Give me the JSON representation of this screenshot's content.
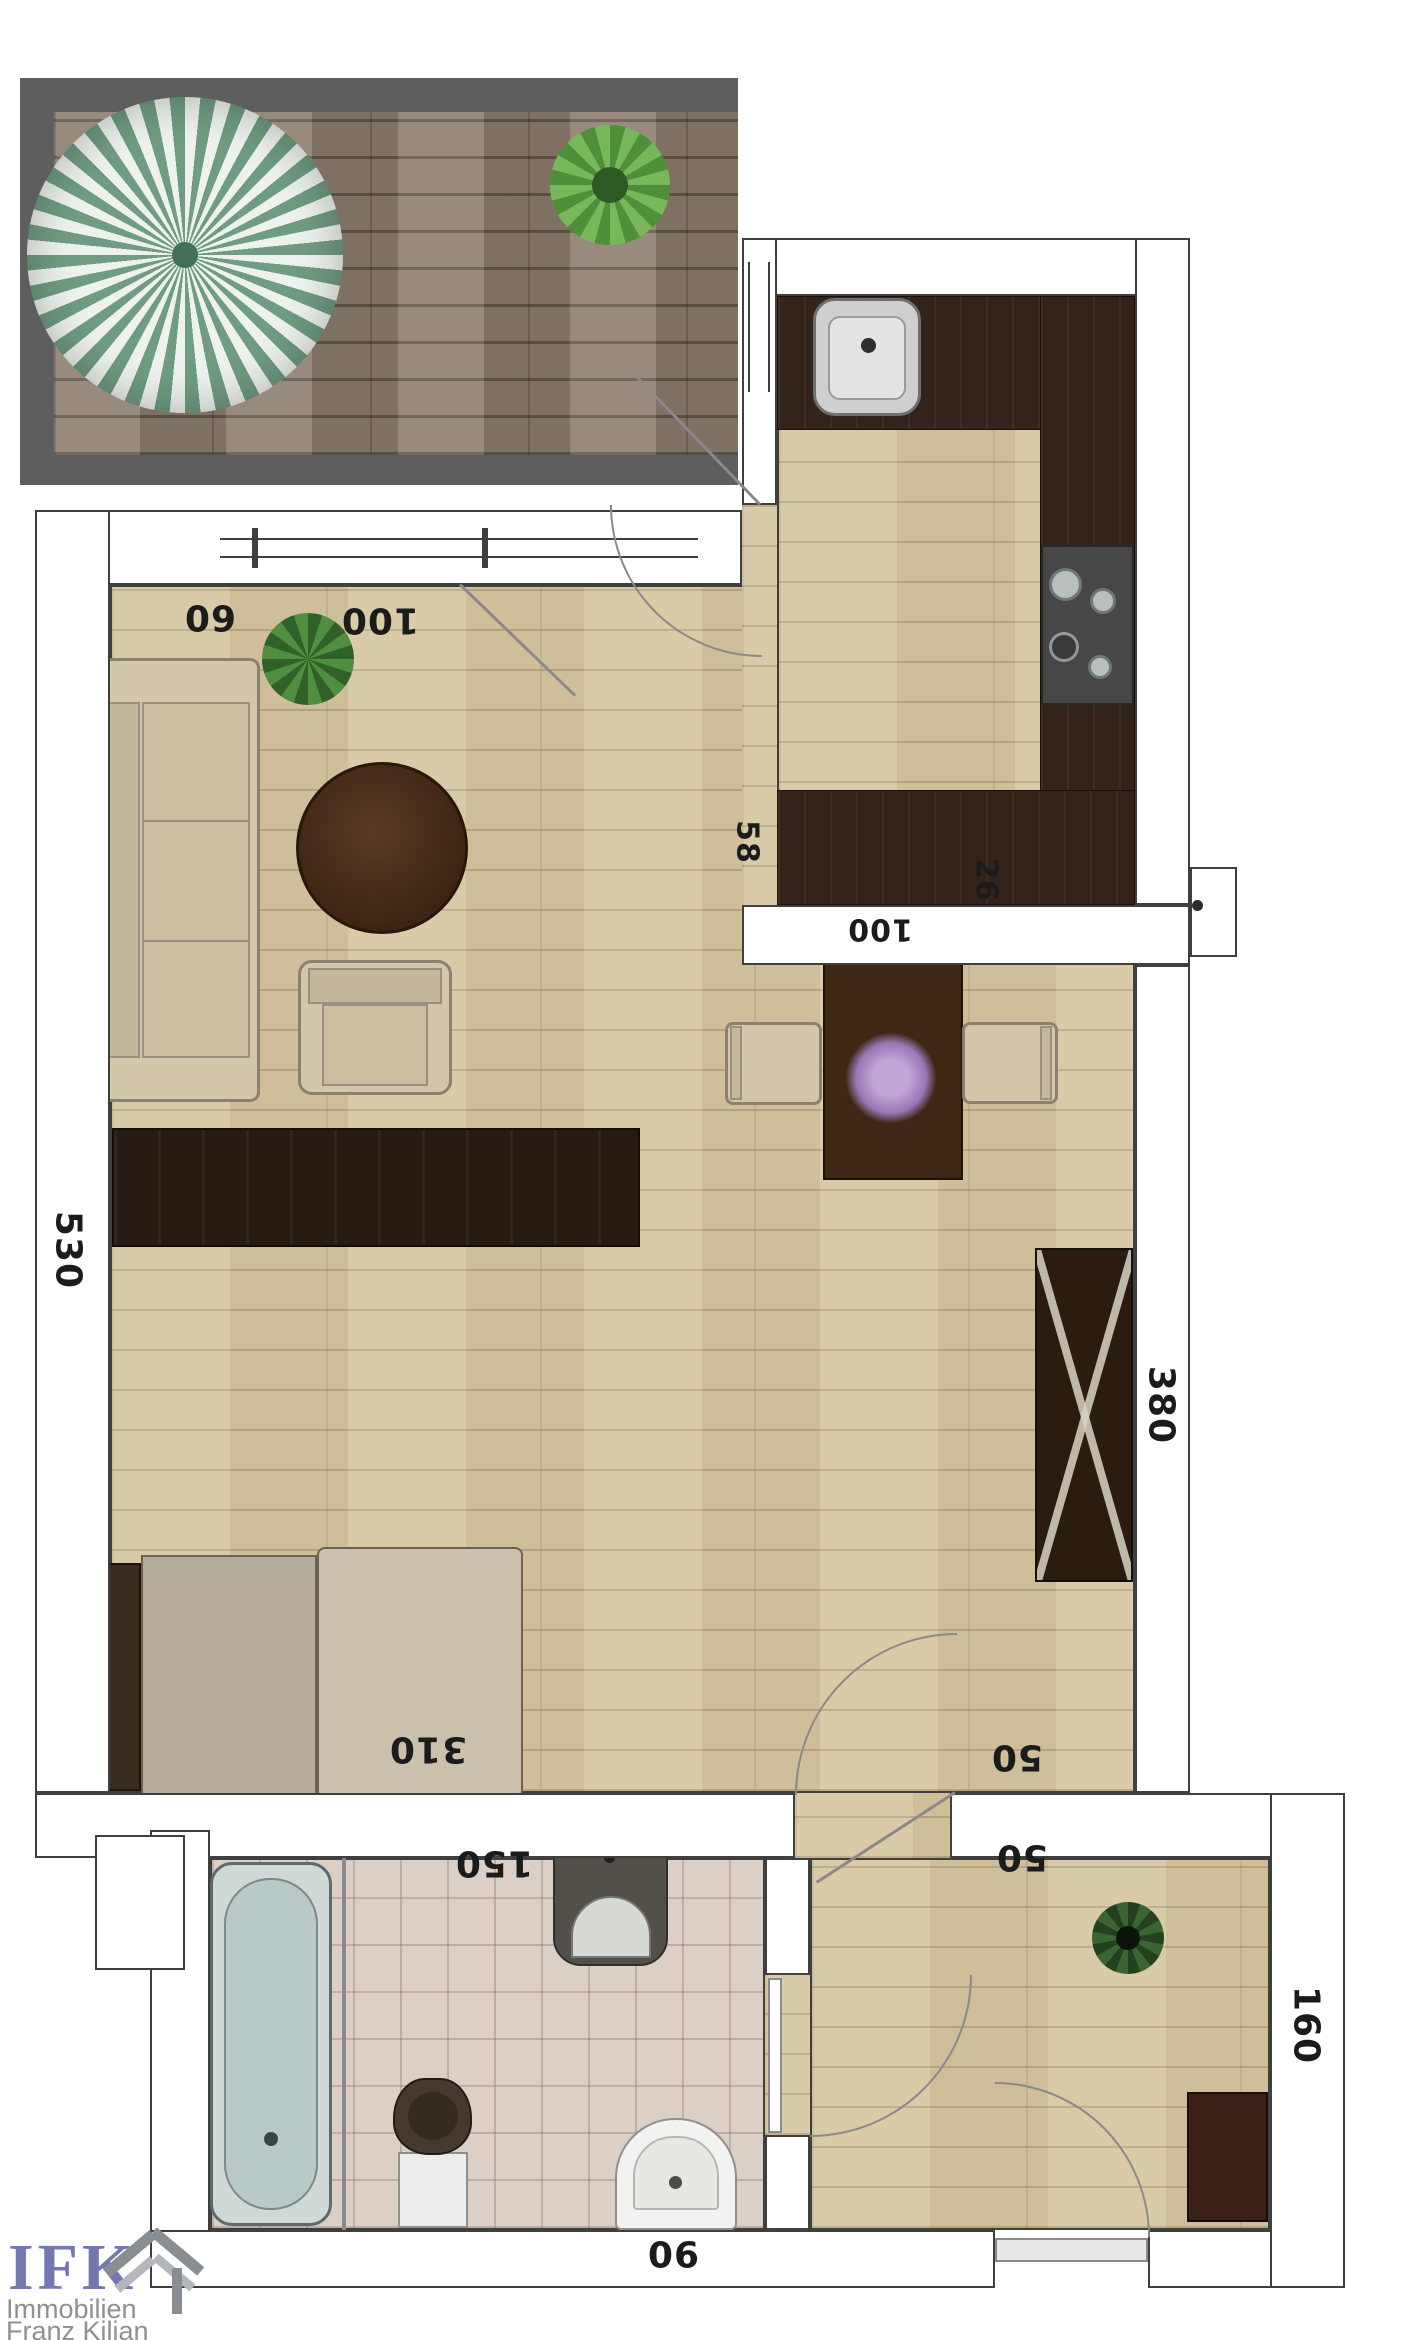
{
  "plan": {
    "dimensions": {
      "top_left": "60",
      "top_right": "100",
      "left_side": "530",
      "right_side": "380",
      "bed_width": "310",
      "bath_width": "150",
      "bath_door": "90",
      "hall_gap_upper": "50",
      "hall_gap_lower": "50",
      "hall_depth": "160",
      "kitchen_counter": "58",
      "kitchen_step": "26",
      "kitchen_width": "100"
    },
    "logo": {
      "brand": "IFK",
      "line1": "Immobilien",
      "line2": "Franz Kilian"
    },
    "colors": {
      "wall_outline": "#3f3f3f",
      "floor_wood": "#d8c8a3",
      "balcony_deck": "#8c7e6f",
      "kitchen_counter": "#33231a",
      "bathroom_tile": "#dccfc6",
      "parasol_green": "#6f9c82",
      "logo_blue": "#7478b1",
      "logo_gray": "#8f9094"
    }
  }
}
